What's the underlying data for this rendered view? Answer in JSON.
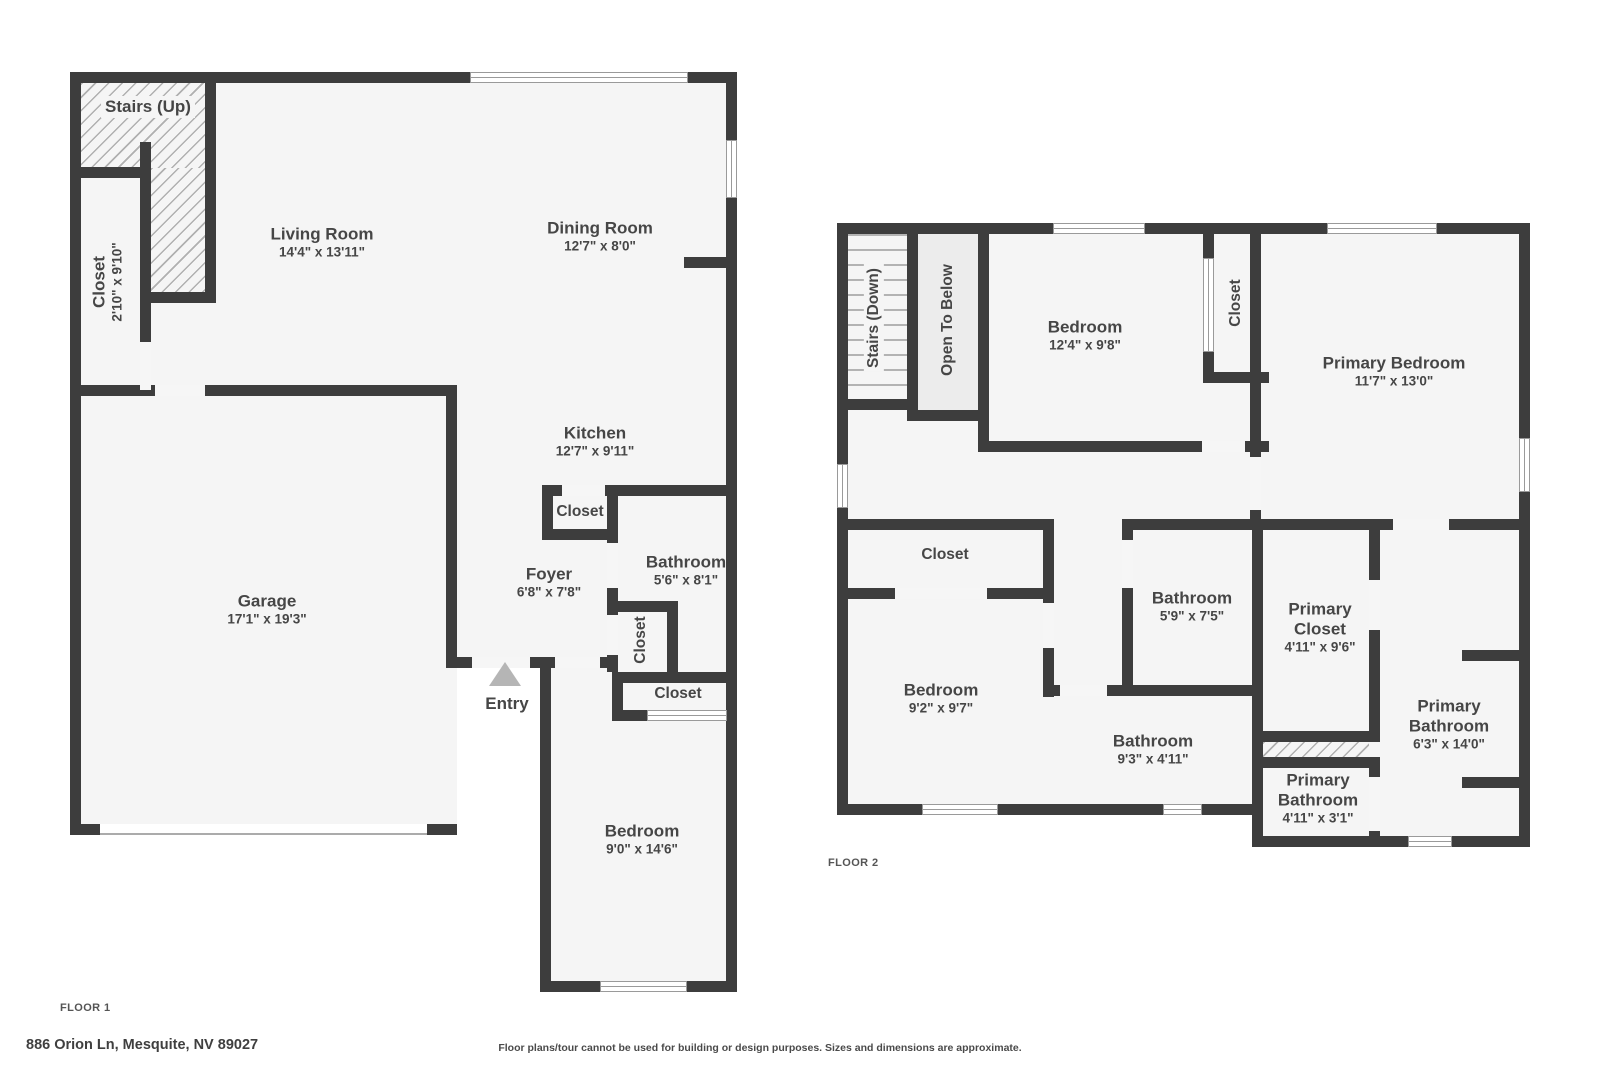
{
  "meta": {
    "address": "886 Orion Ln, Mesquite, NV 89027",
    "disclaimer": "Floor plans/tour cannot be used for building or design purposes. Sizes and dimensions are approximate."
  },
  "floor1": {
    "label": "FLOOR 1",
    "rooms": {
      "stairs_up": {
        "name": "Stairs (Up)",
        "dims": ""
      },
      "closet_tall": {
        "name": "Closet",
        "dims": "2'10\" x 9'10\""
      },
      "living": {
        "name": "Living Room",
        "dims": "14'4\" x 13'11\""
      },
      "dining": {
        "name": "Dining Room",
        "dims": "12'7\" x 8'0\""
      },
      "kitchen": {
        "name": "Kitchen",
        "dims": "12'7\" x 9'11\""
      },
      "pantry": {
        "name": "Closet",
        "dims": ""
      },
      "foyer": {
        "name": "Foyer",
        "dims": "6'8\" x 7'8\""
      },
      "bathroom": {
        "name": "Bathroom",
        "dims": "5'6\" x 8'1\""
      },
      "closet_hall": {
        "name": "Closet",
        "dims": ""
      },
      "closet_bed": {
        "name": "Closet",
        "dims": ""
      },
      "garage": {
        "name": "Garage",
        "dims": "17'1\" x 19'3\""
      },
      "entry": {
        "name": "Entry",
        "dims": ""
      },
      "bedroom": {
        "name": "Bedroom",
        "dims": "9'0\" x 14'6\""
      }
    }
  },
  "floor2": {
    "label": "FLOOR 2",
    "rooms": {
      "stairs_down": {
        "name": "Stairs (Down)",
        "dims": ""
      },
      "open_below": {
        "name": "Open To Below",
        "dims": ""
      },
      "bedroom_top": {
        "name": "Bedroom",
        "dims": "12'4\" x 9'8\""
      },
      "closet_mid": {
        "name": "Closet",
        "dims": ""
      },
      "primary_bedroom": {
        "name": "Primary Bedroom",
        "dims": "11'7\" x 13'0\""
      },
      "closet_left": {
        "name": "Closet",
        "dims": ""
      },
      "bathroom_upper": {
        "name": "Bathroom",
        "dims": "5'9\" x 7'5\""
      },
      "primary_closet": {
        "name": "Primary Closet",
        "dims": "4'11\" x 9'6\""
      },
      "bedroom_left": {
        "name": "Bedroom",
        "dims": "9'2\" x 9'7\""
      },
      "bathroom_lower": {
        "name": "Bathroom",
        "dims": "9'3\" x 4'11\""
      },
      "primary_bathroom_small": {
        "name": "Primary Bathroom",
        "dims": "4'11\" x 3'1\""
      },
      "primary_bathroom": {
        "name": "Primary Bathroom",
        "dims": "6'3\" x 14'0\""
      }
    }
  }
}
